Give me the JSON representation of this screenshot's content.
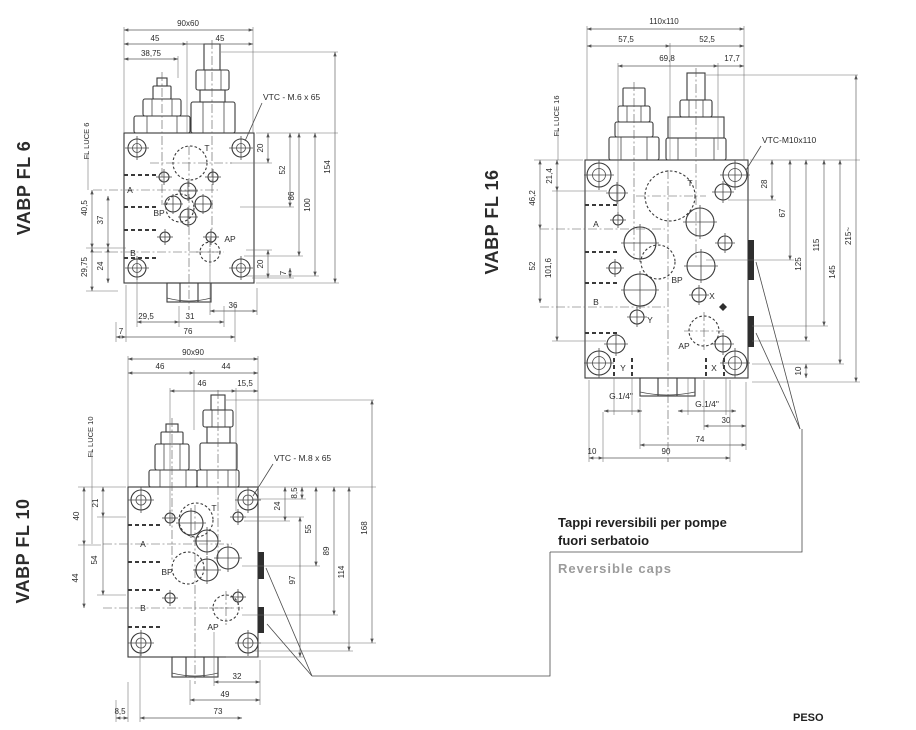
{
  "colors": {
    "line": "#3a3a3a",
    "dim": "#5a5a5a",
    "text": "#2b2b2b",
    "muted": "#9b9b9b",
    "background": "#ffffff"
  },
  "callout": {
    "line1": "Tappi reversibili per pompe",
    "line2": "fuori serbatoio",
    "caption": "Reversible caps"
  },
  "footer": {
    "peso": "PESO"
  },
  "fl6": {
    "title": "VABP FL 6",
    "luce": "FL LUCE 6",
    "vtc": "VTC - M.6 x 65",
    "ports": {
      "t": "T",
      "a": "A",
      "bp": "BP",
      "b": "B",
      "ap": "AP"
    },
    "dims": {
      "flange": "90x60",
      "d45l": "45",
      "d45r": "45",
      "d3875": "38,75",
      "d20t": "20",
      "d52": "52",
      "d86": "86",
      "d100": "100",
      "d154": "154",
      "d20b": "20",
      "d7r": "7",
      "d405": "40,5",
      "d37": "37",
      "d2975": "29,75",
      "d24": "24",
      "d36": "36",
      "d295": "29,5",
      "d31": "31",
      "d7b": "7",
      "d76": "76"
    }
  },
  "fl10": {
    "title": "VABP FL 10",
    "luce": "FL LUCE 10",
    "vtc": "VTC - M.8 x 65",
    "ports": {
      "t": "T",
      "a": "A",
      "bp": "BP",
      "b": "B",
      "ap": "AP"
    },
    "dims": {
      "flange": "90x90",
      "d46a": "46",
      "d44a": "44",
      "d46b": "46",
      "d155": "15,5",
      "d21": "21",
      "d40": "40",
      "d54": "54",
      "d44b": "44",
      "d85r": "8,5",
      "d24": "24",
      "d55": "55",
      "d89": "89",
      "d97": "97",
      "d114": "114",
      "d168": "168",
      "d32": "32",
      "d49": "49",
      "d73": "73",
      "d85b": "8,5"
    }
  },
  "fl16": {
    "title": "VABP FL 16",
    "luce": "FL LUCE 16",
    "vtc": "VTC-M10x110",
    "ports": {
      "t": "T",
      "a": "A",
      "bp": "BP",
      "b": "B",
      "x": "X",
      "y": "Y",
      "xb": "X",
      "yb": "Y",
      "ap": "AP",
      "g14a": "G.1/4\"",
      "g14b": "G.1/4\""
    },
    "dims": {
      "flange": "110x110",
      "d575": "57,5",
      "d525": "52,5",
      "d698": "69,8",
      "d177": "17,7",
      "d214": "21,4",
      "d462": "46,2",
      "d52": "52",
      "d1016": "101,6",
      "d28": "28",
      "d67": "67",
      "d115": "115",
      "d125": "125",
      "d145": "145",
      "d215": "215~",
      "d10r": "10",
      "d30": "30",
      "d74": "74",
      "d10b": "10",
      "d90": "90"
    }
  }
}
